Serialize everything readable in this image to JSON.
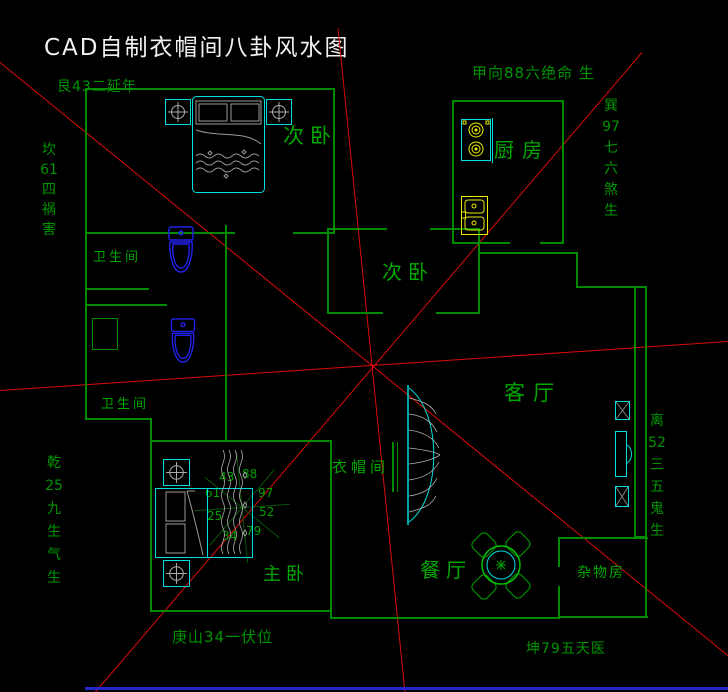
{
  "title": "CAD自制衣帽间八卦风水图",
  "compass": {
    "top_facing": "甲向88六绝命 生",
    "top_left": "艮43二延年",
    "left_upper": "坎\n61\n四\n祸\n害",
    "left_lower": "乾\n25\n九\n生\n气\n生",
    "right_upper": "巽\n97\n七\n六\n煞\n生",
    "right_lower": "离\n52\n三\n五\n鬼\n生",
    "bottom_left": "庚山34一伏位",
    "bottom_right": "坤79五天医"
  },
  "rooms": {
    "bedroom_top": "次卧",
    "kitchen": "厨房",
    "bedroom_mid": "次卧",
    "living": "客厅",
    "cloakroom": "衣帽间",
    "master": "主卧",
    "dining": "餐厅",
    "storage": "杂物房",
    "bath1": "卫生间",
    "bath2": "卫生间"
  },
  "star_numbers": {
    "n43": "43",
    "n88": "88",
    "n61": "61",
    "n97": "97",
    "n25": "25",
    "n52": "52",
    "n34": "34",
    "n79": "79"
  },
  "colors": {
    "wall_green": "#008a00",
    "text_green": "#00a000",
    "red_line": "#dd0a0a",
    "furniture_cyan": "#00dede",
    "toilet_blue": "#2222ee",
    "fixture_yellow": "#eded00",
    "title_white": "#f2f2f2",
    "bottom_bar_blue": "#2525cd"
  }
}
